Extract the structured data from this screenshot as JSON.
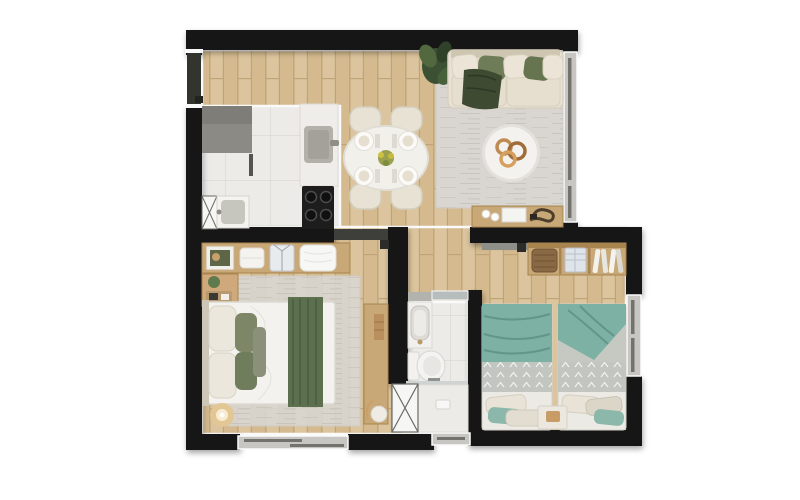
{
  "page": {
    "title": "Apartment floor plan — top view render"
  },
  "palette": {
    "c-wall": "#181818",
    "c-outline": "#fafafa",
    "c-wood": "#dcc59e",
    "c-wood2": "#d4ba8e",
    "c-woodline": "#c0a478",
    "c-tile": "#ecebe8",
    "c-tileline": "#dbd9d4",
    "c-rug": "#d9d6d1",
    "c-sofa": "#e9e2d4",
    "c-green": "#6e7c58",
    "c-throw": "#3f4a33",
    "c-runner": "#5c7050",
    "c-teal": "#7cb1a4",
    "c-tealdark": "#639588",
    "c-quilt": "#c2c6c0",
    "c-tan": "#c9a877",
    "c-gray": "#8b8a85",
    "c-white": "#f4f3f0",
    "c-steel": "#b2b0a8",
    "c-frame": "#c7c6c2",
    "c-glass": "#73726d"
  },
  "plan": {
    "rooms": [
      {
        "id": "kitchen",
        "furniture": [
          "gray-counter",
          "island-with-sink",
          "stove-4-burners",
          "laundry-sink",
          "washer-space-x"
        ]
      },
      {
        "id": "dining-area",
        "furniture": [
          "oval-table",
          "chairs-4",
          "place-settings-4",
          "flower-centerpiece"
        ]
      },
      {
        "id": "living-room",
        "furniture": [
          "sofa",
          "green-pillows",
          "dark-throw",
          "potted-plant",
          "area-rug",
          "round-coffee-table",
          "console-table",
          "cups",
          "book",
          "rope-decor"
        ]
      },
      {
        "id": "bedroom-1",
        "furniture": [
          "double-bed",
          "green-runner",
          "pillows",
          "headboard-shelf",
          "nightstand",
          "desk",
          "floor-lamp",
          "area-rug"
        ]
      },
      {
        "id": "bathroom",
        "furniture": [
          "vanity-sink",
          "mirror-shelf",
          "toilet",
          "shower-with-glass",
          "shaft-x"
        ]
      },
      {
        "id": "bedroom-2",
        "furniture": [
          "single-bed-left",
          "single-bed-right",
          "teal-blankets",
          "patterned-quilts",
          "nightstand",
          "open-wardrobe",
          "basket",
          "folded-shirts",
          "hanging-clothes"
        ]
      },
      {
        "id": "hallway",
        "furniture": []
      }
    ],
    "openings": [
      "entry-door",
      "bedroom-1-door",
      "bedroom-2-door",
      "bathroom-door",
      "living-room-window",
      "bedroom-1-window",
      "bedroom-2-window",
      "bathroom-window"
    ]
  }
}
